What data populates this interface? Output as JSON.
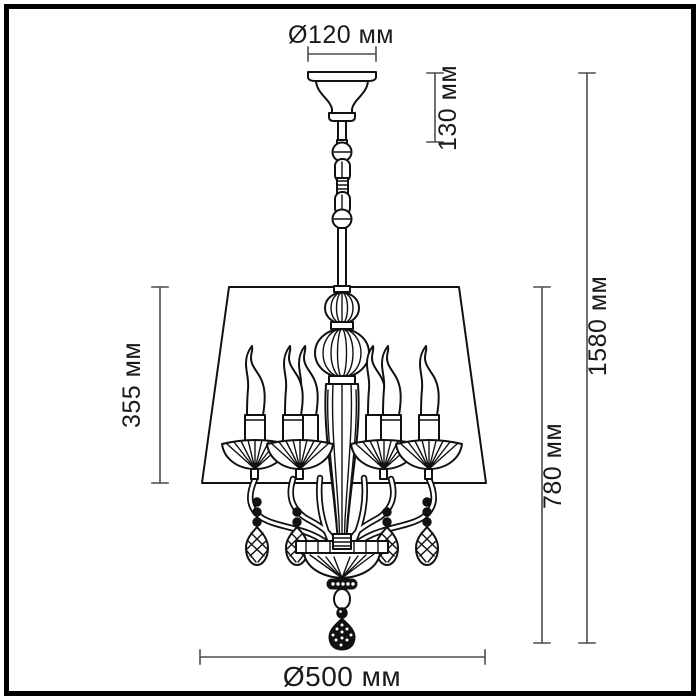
{
  "colors": {
    "background": "#ffffff",
    "frame": "#000000",
    "drawing_line": "#111111",
    "dimension_line": "#4d4d4d",
    "label_text": "#1a1a1a"
  },
  "dimensions": {
    "canopy_diameter": {
      "label": "Ø120 мм",
      "value_mm": 120
    },
    "suspension_height": {
      "label": "130 мм",
      "value_mm": 130
    },
    "shade_height": {
      "label": "355 мм",
      "value_mm": 355
    },
    "body_height": {
      "label": "780 мм",
      "value_mm": 780
    },
    "total_height": {
      "label": "1580 мм",
      "value_mm": 1580
    },
    "shade_diameter": {
      "label": "Ø500 мм",
      "value_mm": 500
    }
  }
}
